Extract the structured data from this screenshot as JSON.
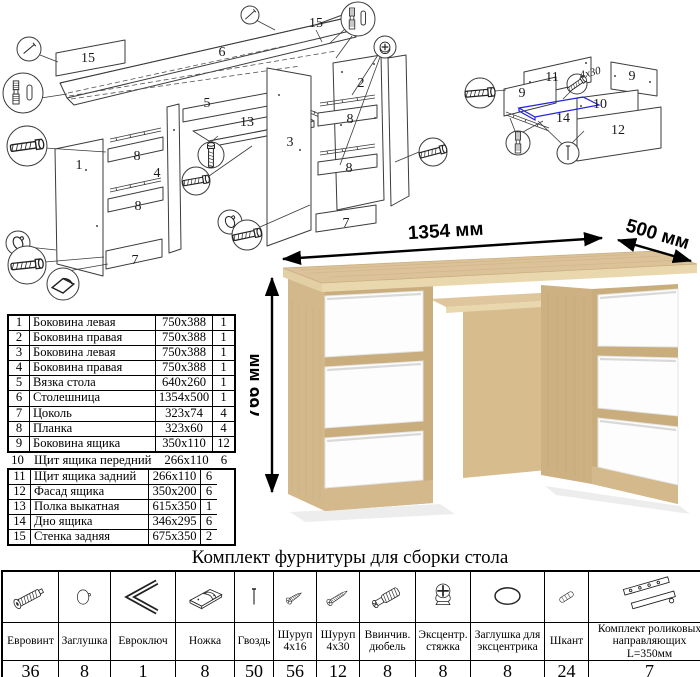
{
  "colors": {
    "oak_top": "#dcc298",
    "oak_side": "#d3b88b",
    "oak_gap": "#c9ad7d",
    "drawer_white": "#fdfdfd",
    "highlight_blue": "#2222dd"
  },
  "diagram_main": {
    "labels": {
      "p15a": "15",
      "p15b": "15",
      "p6": "6",
      "p5": "5",
      "p13": "13",
      "p1": "1",
      "p4": "4",
      "p8a": "8",
      "p8b": "8",
      "p7a": "7",
      "p3": "3",
      "p2": "2",
      "p8c": "8",
      "p8d": "8",
      "p7b": "7"
    }
  },
  "diagram_drawer": {
    "labels": {
      "p11": "11",
      "p9a": "9",
      "p9b": "9",
      "p10": "10",
      "p14": "14",
      "p12": "12"
    },
    "screw_note": "4х30"
  },
  "desk_render": {
    "width_label": "1354 мм",
    "depth_label": "500 мм",
    "height_label": "766 мм"
  },
  "parts_table": {
    "rows": [
      {
        "num": "1",
        "name": "Боковина левая",
        "size": "750х388",
        "qty": "1"
      },
      {
        "num": "2",
        "name": "Боковина правая",
        "size": "750х388",
        "qty": "1"
      },
      {
        "num": "3",
        "name": "Боковина левая",
        "size": "750х388",
        "qty": "1"
      },
      {
        "num": "4",
        "name": "Боковина правая",
        "size": "750х388",
        "qty": "1"
      },
      {
        "num": "5",
        "name": "Вязка стола",
        "size": "640х260",
        "qty": "1"
      },
      {
        "num": "6",
        "name": "Столешница",
        "size": "1354х500",
        "qty": "1"
      },
      {
        "num": "7",
        "name": "Цоколь",
        "size": "323х74",
        "qty": "4"
      },
      {
        "num": "8",
        "name": "Планка",
        "size": "323х60",
        "qty": "4"
      },
      {
        "num": "9",
        "name": "Боковина ящика",
        "size": "350х110",
        "qty": "12"
      },
      {
        "num": "10",
        "name": "Щит ящика передний",
        "size": "266х110",
        "qty": "6"
      },
      {
        "num": "11",
        "name": "Щит ящика задний",
        "size": "266х110",
        "qty": "6"
      },
      {
        "num": "12",
        "name": "Фасад ящика",
        "size": "350х200",
        "qty": "6"
      },
      {
        "num": "13",
        "name": "Полка выкатная",
        "size": "615х350",
        "qty": "1"
      },
      {
        "num": "14",
        "name": "Дно ящика",
        "size": "346х295",
        "qty": "6"
      },
      {
        "num": "15",
        "name": "Стенка задняя",
        "size": "675х350",
        "qty": "2"
      }
    ]
  },
  "hardware": {
    "title": "Комплект фурнитуры для сборки стола",
    "items": [
      {
        "name": "Евровинт",
        "qty": "36",
        "icon": "euro-screw-icon"
      },
      {
        "name": "Заглушка",
        "qty": "8",
        "icon": "cap-icon"
      },
      {
        "name": "Евроключ",
        "qty": "1",
        "icon": "hex-key-icon"
      },
      {
        "name": "Ножка",
        "qty": "8",
        "icon": "foot-icon"
      },
      {
        "name": "Гвоздь",
        "qty": "50",
        "icon": "nail-icon"
      },
      {
        "name": "Шуруп 4х16",
        "qty": "56",
        "icon": "screw-small-icon"
      },
      {
        "name": "Шуруп 4х30",
        "qty": "12",
        "icon": "screw-large-icon"
      },
      {
        "name": "Ввинчив. дюбель",
        "qty": "8",
        "icon": "dowel-bolt-icon"
      },
      {
        "name": "Эксцентр. стяжка",
        "qty": "8",
        "icon": "cam-lock-icon"
      },
      {
        "name": "Заглушка для эксцентрика",
        "qty": "8",
        "icon": "cam-cap-icon"
      },
      {
        "name": "Шкант",
        "qty": "24",
        "icon": "wood-dowel-icon"
      },
      {
        "name": "Комплект роликовых направляющих L=350мм",
        "qty": "7",
        "icon": "drawer-slides-icon"
      }
    ]
  }
}
